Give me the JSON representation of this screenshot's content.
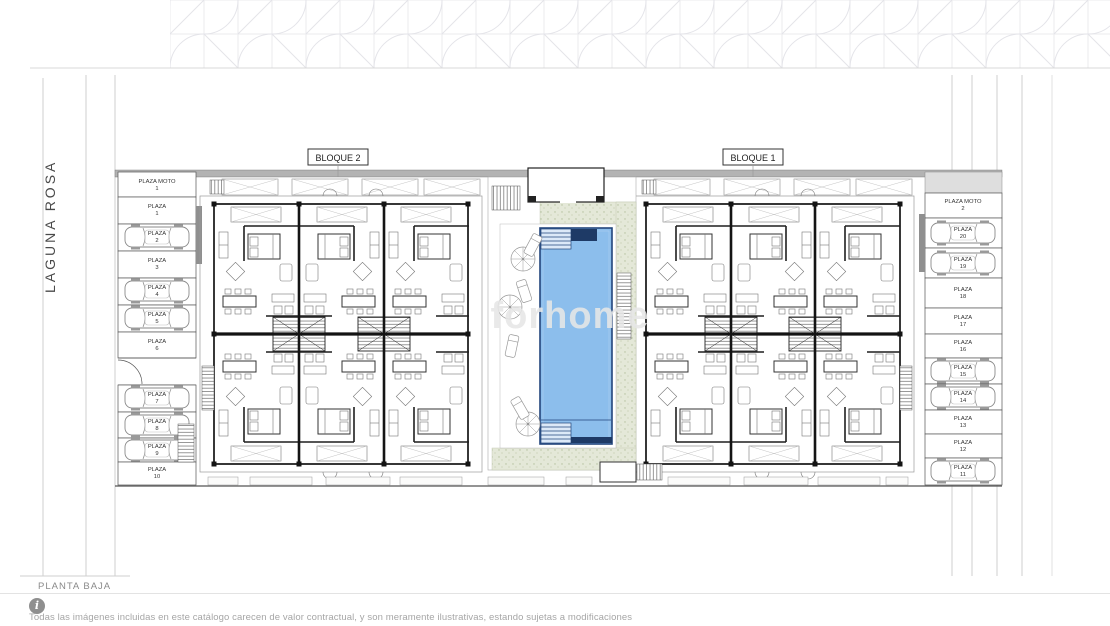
{
  "street": {
    "label": "LAGUNA ROSA"
  },
  "plan": {
    "label": "PLANTA BAJA"
  },
  "blocks": [
    {
      "label": "BLOQUE 2"
    },
    {
      "label": "BLOQUE 1"
    }
  ],
  "watermark": {
    "text": "forhome"
  },
  "footer": {
    "info_glyph": "i",
    "disclaimer": "Todas las imágenes incluidas en este catálogo carecen de valor contractual, y son meramente ilustrativas, estando sujetas a modificaciones"
  },
  "parking": {
    "left": [
      {
        "name": "PLAZA MOTO",
        "number": "1",
        "car": false
      },
      {
        "name": "PLAZA",
        "number": "1",
        "car": false
      },
      {
        "name": "PLAZA",
        "number": "2",
        "car": true
      },
      {
        "name": "PLAZA",
        "number": "3",
        "car": false
      },
      {
        "name": "PLAZA",
        "number": "4",
        "car": true
      },
      {
        "name": "PLAZA",
        "number": "5",
        "car": true
      },
      {
        "name": "PLAZA",
        "number": "6",
        "car": false
      },
      {
        "name": "PLAZA",
        "number": "7",
        "car": true
      },
      {
        "name": "PLAZA",
        "number": "8",
        "car": true
      },
      {
        "name": "PLAZA",
        "number": "9",
        "car": true
      },
      {
        "name": "PLAZA",
        "number": "10",
        "car": false
      }
    ],
    "right": [
      {
        "name": "PLAZA MOTO",
        "number": "2",
        "car": false
      },
      {
        "name": "PLAZA",
        "number": "20",
        "car": true
      },
      {
        "name": "PLAZA",
        "number": "19",
        "car": true
      },
      {
        "name": "PLAZA",
        "number": "18",
        "car": false
      },
      {
        "name": "PLAZA",
        "number": "17",
        "car": false
      },
      {
        "name": "PLAZA",
        "number": "16",
        "car": false
      },
      {
        "name": "PLAZA",
        "number": "15",
        "car": true
      },
      {
        "name": "PLAZA",
        "number": "14",
        "car": true
      },
      {
        "name": "PLAZA",
        "number": "13",
        "car": false
      },
      {
        "name": "PLAZA",
        "number": "12",
        "car": false
      },
      {
        "name": "PLAZA",
        "number": "11",
        "car": true
      }
    ]
  },
  "colors": {
    "pool_fill": "#8CBEEC",
    "pool_edge": "#23457C",
    "landscape": "#E4E8D8",
    "plan_line": "#141414",
    "road_line": "#CFCFCF",
    "watermark": "#E7E7E7",
    "footer_gray": "#A6A6A6"
  }
}
